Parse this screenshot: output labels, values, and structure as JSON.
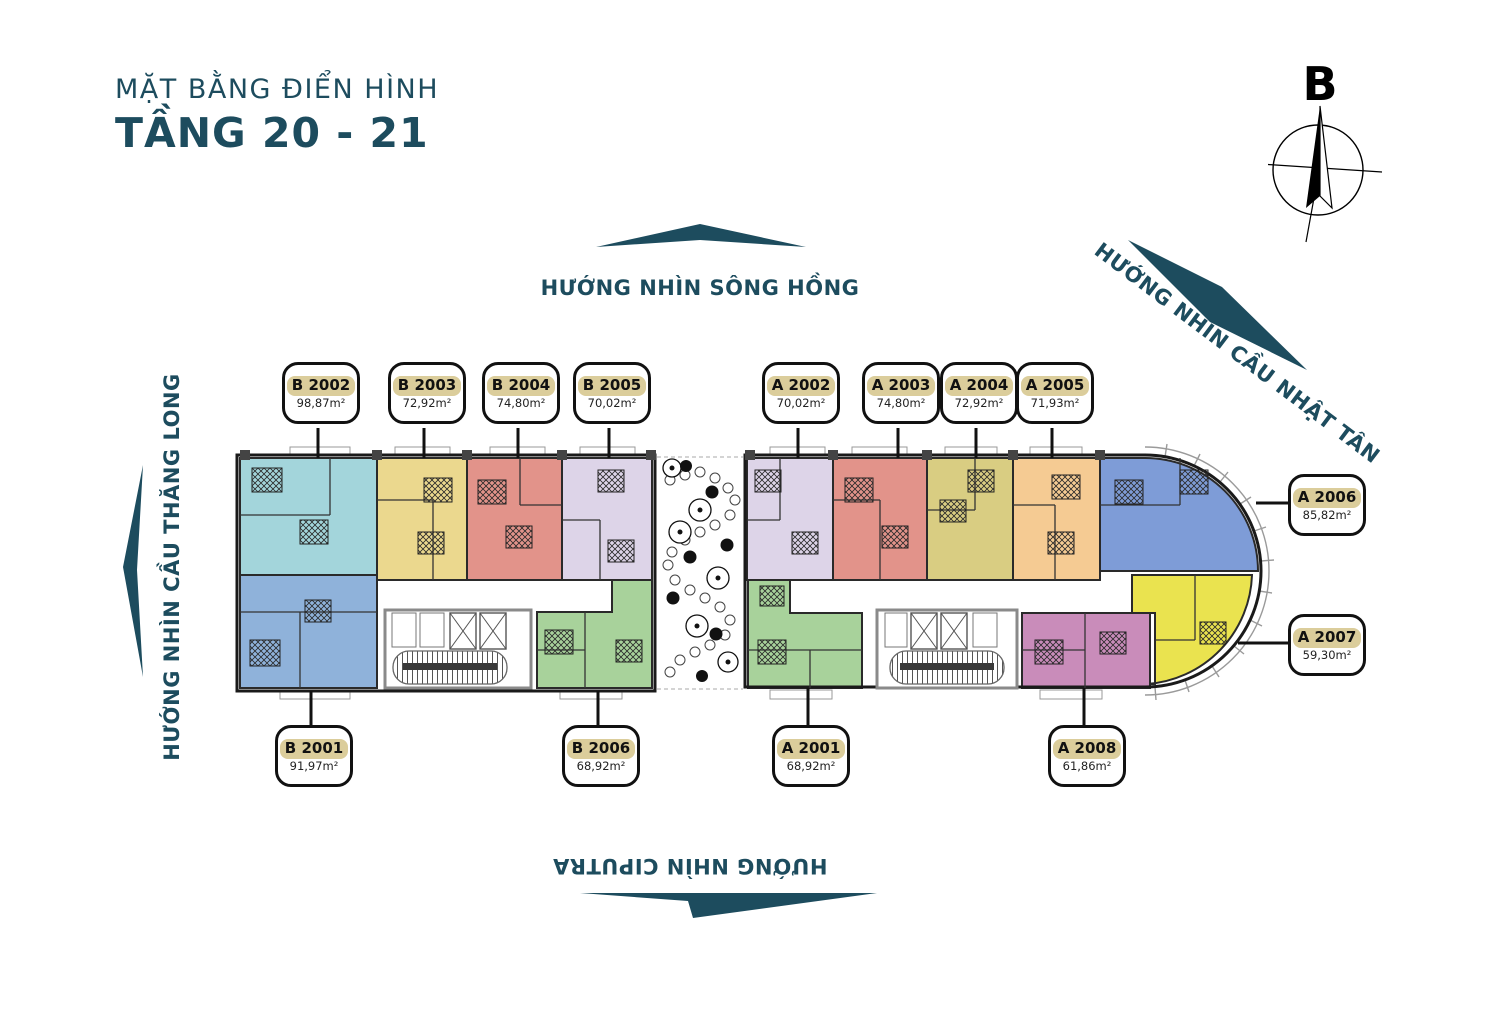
{
  "title": {
    "subtitle": "MẶT BẰNG ĐIỂN HÌNH",
    "main": "TẦNG 20 - 21"
  },
  "compass": {
    "north_label": "B"
  },
  "directions": {
    "top": "HƯỚNG NHÌN SÔNG HỒNG",
    "top_right": "HƯỚNG NHÌN CẦU NHẬT TÂN",
    "left": "HƯỚNG NHÌN CẦU THĂNG LONG",
    "bottom": "HƯỚNG NHÌN CIPUTRA"
  },
  "colors": {
    "accent_teal": "#1D4C5E",
    "label_highlight": "#DBCD9B",
    "callout_border": "#111111",
    "wall": "#1A1A1A"
  },
  "units": [
    {
      "id": "B 2001",
      "area": "91,97m²",
      "color": "#8FB2DA"
    },
    {
      "id": "B 2002",
      "area": "98,87m²",
      "color": "#A3D5DB"
    },
    {
      "id": "B 2003",
      "area": "72,92m²",
      "color": "#EBD88E"
    },
    {
      "id": "B 2004",
      "area": "74,80m²",
      "color": "#E2938A"
    },
    {
      "id": "B 2005",
      "area": "70,02m²",
      "color": "#DDD4E8"
    },
    {
      "id": "B 2006",
      "area": "68,92m²",
      "color": "#A8D29B"
    },
    {
      "id": "A 2001",
      "area": "68,92m²",
      "color": "#A8D29B"
    },
    {
      "id": "A 2002",
      "area": "70,02m²",
      "color": "#DDD4E8"
    },
    {
      "id": "A 2003",
      "area": "74,80m²",
      "color": "#E2938A"
    },
    {
      "id": "A 2004",
      "area": "72,92m²",
      "color": "#D9CD82"
    },
    {
      "id": "A 2005",
      "area": "71,93m²",
      "color": "#F5CB93"
    },
    {
      "id": "A 2006",
      "area": "85,82m²",
      "color": "#7E9CD7"
    },
    {
      "id": "A 2007",
      "area": "59,30m²",
      "color": "#EAE34F"
    },
    {
      "id": "A 2008",
      "area": "61,86m²",
      "color": "#C98CBA"
    }
  ]
}
